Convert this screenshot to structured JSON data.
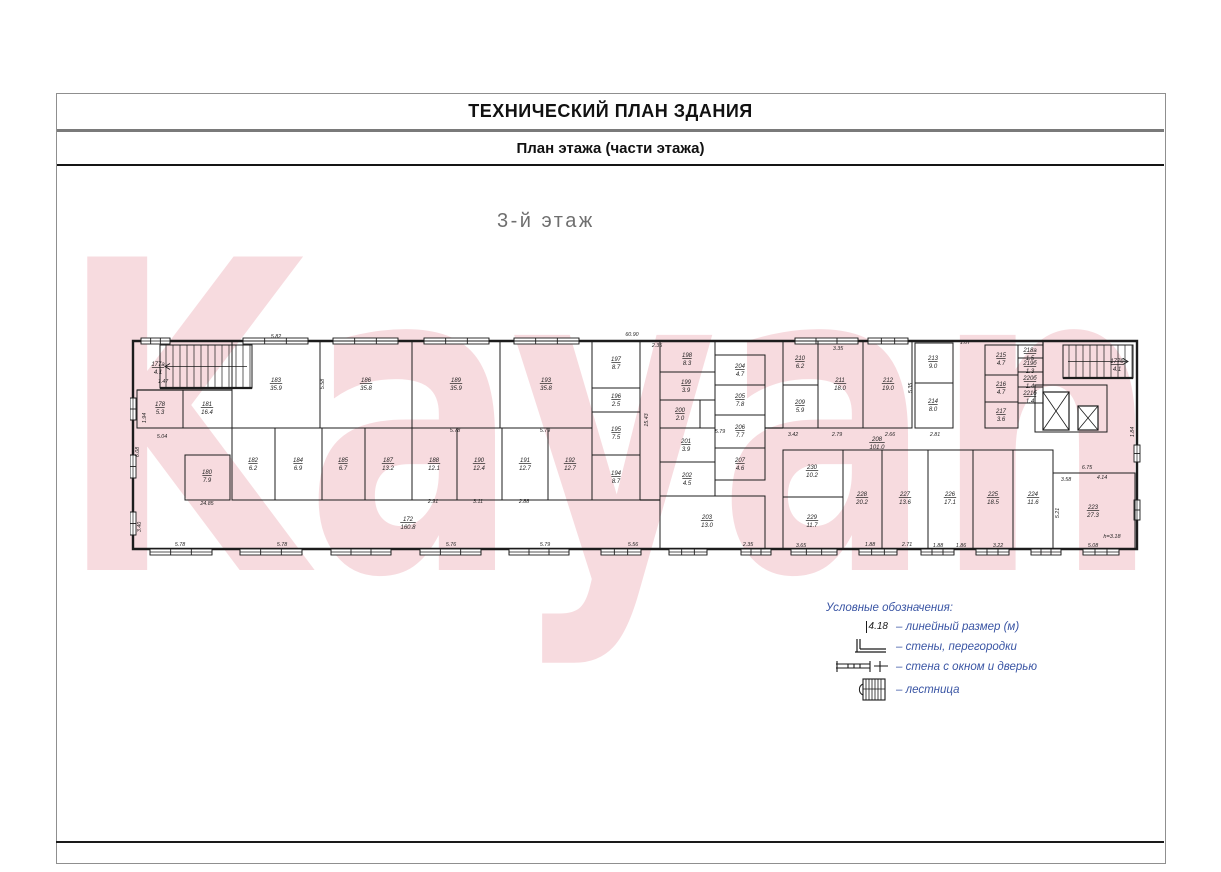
{
  "page": {
    "title": "ТЕХНИЧЕСКИЙ ПЛАН ЗДАНИЯ",
    "subtitle": "План этажа (части этажа)",
    "floor_label": "3-й этаж",
    "watermark": "Kayan"
  },
  "colors": {
    "watermark_pink": "#f6d3d8",
    "legend_blue": "#3a55a4",
    "wall_black": "#1c1c1c",
    "dim_text": "#1f1f1f",
    "floor_label_gray": "#6f6f6f"
  },
  "legend": {
    "heading": "Условные обозначения:",
    "items": [
      {
        "symbol": "linear-dimension",
        "sample": "4.18",
        "label": "– линейный размер (м)"
      },
      {
        "symbol": "walls-partitions",
        "sample": "",
        "label": "– стены, перегородки"
      },
      {
        "symbol": "wall-window-door",
        "sample": "",
        "label": "– стена с окном и дверью"
      },
      {
        "symbol": "stairs",
        "sample": "",
        "label": "– лестница"
      }
    ]
  },
  "plan": {
    "note": {
      "text": "h=3.18",
      "x": 1112,
      "y": 538
    },
    "rooms": [
      {
        "num": "177а",
        "area": "4.1",
        "label": [
          158,
          366
        ]
      },
      {
        "num": "178",
        "area": "5.3",
        "rect": [
          137,
          390,
          46,
          38
        ],
        "label": [
          160,
          406
        ]
      },
      {
        "num": "181",
        "area": "16.4",
        "rect": [
          183,
          390,
          49,
          38
        ],
        "label": [
          207,
          406
        ]
      },
      {
        "num": "183",
        "area": "35.9",
        "rect": [
          232,
          341,
          88,
          87
        ],
        "label": [
          276,
          382
        ]
      },
      {
        "num": "186",
        "area": "35.8",
        "rect": [
          320,
          341,
          92,
          87
        ],
        "label": [
          366,
          382
        ]
      },
      {
        "num": "189",
        "area": "35.9",
        "rect": [
          412,
          341,
          88,
          87
        ],
        "label": [
          456,
          382
        ]
      },
      {
        "num": "193",
        "area": "35.8",
        "rect": [
          500,
          341,
          92,
          87
        ],
        "label": [
          546,
          382
        ]
      },
      {
        "num": "180",
        "area": "7.9",
        "rect": [
          185,
          455,
          45,
          45
        ],
        "label": [
          207,
          474
        ]
      },
      {
        "num": "182",
        "area": "6.2",
        "rect": [
          232,
          428,
          43,
          72
        ],
        "label": [
          253,
          462
        ]
      },
      {
        "num": "184",
        "area": "6.9",
        "rect": [
          275,
          428,
          47,
          72
        ],
        "label": [
          298,
          462
        ]
      },
      {
        "num": "185",
        "area": "6.7",
        "rect": [
          322,
          428,
          43,
          72
        ],
        "label": [
          343,
          462
        ]
      },
      {
        "num": "187",
        "area": "13.2",
        "rect": [
          365,
          428,
          47,
          72
        ],
        "label": [
          388,
          462
        ]
      },
      {
        "num": "188",
        "area": "12.1",
        "rect": [
          412,
          428,
          45,
          72
        ],
        "label": [
          434,
          462
        ]
      },
      {
        "num": "190",
        "area": "12.4",
        "rect": [
          457,
          428,
          45,
          72
        ],
        "label": [
          479,
          462
        ]
      },
      {
        "num": "191",
        "area": "12.7",
        "rect": [
          502,
          428,
          46,
          72
        ],
        "label": [
          525,
          462
        ]
      },
      {
        "num": "192",
        "area": "12.7",
        "rect": [
          548,
          428,
          44,
          72
        ],
        "label": [
          570,
          462
        ]
      },
      {
        "num": "172",
        "area": "160.8",
        "label": [
          408,
          521
        ]
      },
      {
        "num": "197",
        "area": "8.7",
        "rect": [
          592,
          341,
          48,
          47
        ],
        "label": [
          616,
          361
        ]
      },
      {
        "num": "196",
        "area": "2.5",
        "rect": [
          592,
          388,
          48,
          24
        ],
        "label": [
          616,
          398
        ]
      },
      {
        "num": "195",
        "area": "7.5",
        "rect": [
          592,
          412,
          48,
          43
        ],
        "label": [
          616,
          431
        ]
      },
      {
        "num": "194",
        "area": "8.7",
        "rect": [
          592,
          455,
          48,
          45
        ],
        "label": [
          616,
          475
        ]
      },
      {
        "num": "198",
        "area": "8.3",
        "rect": [
          660,
          341,
          55,
          31
        ],
        "label": [
          687,
          357
        ]
      },
      {
        "num": "199",
        "area": "3.9",
        "rect": [
          660,
          372,
          55,
          28
        ],
        "label": [
          686,
          384
        ]
      },
      {
        "num": "200",
        "area": "2.0",
        "rect": [
          660,
          400,
          40,
          28
        ],
        "label": [
          680,
          412
        ]
      },
      {
        "num": "201",
        "area": "3.9",
        "rect": [
          660,
          428,
          55,
          34
        ],
        "label": [
          686,
          443
        ]
      },
      {
        "num": "202",
        "area": "4.5",
        "rect": [
          660,
          462,
          55,
          34
        ],
        "label": [
          687,
          477
        ]
      },
      {
        "num": "204",
        "area": "4.7",
        "rect": [
          715,
          355,
          50,
          30
        ],
        "label": [
          740,
          368
        ]
      },
      {
        "num": "205",
        "area": "7.8",
        "rect": [
          715,
          385,
          50,
          30
        ],
        "label": [
          740,
          398
        ]
      },
      {
        "num": "206",
        "area": "7.7",
        "rect": [
          715,
          415,
          50,
          33
        ],
        "label": [
          740,
          429
        ]
      },
      {
        "num": "207",
        "area": "4.6",
        "rect": [
          715,
          448,
          50,
          32
        ],
        "label": [
          740,
          462
        ]
      },
      {
        "num": "203",
        "area": "13.0",
        "rect": [
          660,
          496,
          105,
          53
        ],
        "label": [
          707,
          519
        ]
      },
      {
        "num": "210",
        "area": "6.2",
        "rect": [
          783,
          341,
          35,
          44
        ],
        "label": [
          800,
          360
        ]
      },
      {
        "num": "209",
        "area": "5.9",
        "rect": [
          783,
          385,
          35,
          43
        ],
        "label": [
          800,
          404
        ]
      },
      {
        "num": "211",
        "area": "18.0",
        "rect": [
          818,
          341,
          45,
          87
        ],
        "label": [
          840,
          382
        ]
      },
      {
        "num": "212",
        "area": "19.0",
        "rect": [
          863,
          341,
          49,
          87
        ],
        "label": [
          888,
          382
        ]
      },
      {
        "num": "213",
        "area": "9.0",
        "rect": [
          915,
          343,
          38,
          40
        ],
        "label": [
          933,
          360
        ]
      },
      {
        "num": "214",
        "area": "8.0",
        "rect": [
          915,
          383,
          38,
          45
        ],
        "label": [
          933,
          403
        ]
      },
      {
        "num": "215",
        "area": "4.7",
        "rect": [
          985,
          345,
          33,
          30
        ],
        "label": [
          1001,
          357
        ]
      },
      {
        "num": "216",
        "area": "4.7",
        "rect": [
          985,
          375,
          33,
          27
        ],
        "label": [
          1001,
          386
        ]
      },
      {
        "num": "217",
        "area": "3.6",
        "rect": [
          985,
          402,
          33,
          26
        ],
        "label": [
          1001,
          413
        ]
      },
      {
        "num": "218а",
        "area": "1.5",
        "rect": [
          1018,
          345,
          25,
          13
        ],
        "label": [
          1030,
          352
        ]
      },
      {
        "num": "219б",
        "area": "1.3",
        "rect": [
          1018,
          358,
          25,
          14
        ],
        "label": [
          1030,
          365
        ]
      },
      {
        "num": "220б",
        "area": "1.4",
        "rect": [
          1018,
          372,
          25,
          15
        ],
        "label": [
          1030,
          380
        ]
      },
      {
        "num": "221б",
        "area": "1.4",
        "rect": [
          1018,
          387,
          25,
          16
        ],
        "label": [
          1030,
          395
        ]
      },
      {
        "num": "208",
        "area": "101.0",
        "label": [
          877,
          441
        ]
      },
      {
        "num": "230",
        "area": "10.2",
        "rect": [
          783,
          450,
          60,
          47
        ],
        "label": [
          812,
          469
        ]
      },
      {
        "num": "229",
        "area": "11.7",
        "rect": [
          783,
          497,
          60,
          52
        ],
        "label": [
          812,
          519
        ]
      },
      {
        "num": "228",
        "area": "20.2",
        "rect": [
          843,
          450,
          39,
          99
        ],
        "label": [
          862,
          496
        ]
      },
      {
        "num": "227",
        "area": "13.6",
        "rect": [
          882,
          450,
          46,
          99
        ],
        "label": [
          905,
          496
        ]
      },
      {
        "num": "226",
        "area": "17.1",
        "rect": [
          928,
          450,
          45,
          99
        ],
        "label": [
          950,
          496
        ]
      },
      {
        "num": "225",
        "area": "18.5",
        "rect": [
          973,
          450,
          40,
          99
        ],
        "label": [
          993,
          496
        ]
      },
      {
        "num": "224",
        "area": "11.6",
        "rect": [
          1013,
          450,
          40,
          99
        ],
        "label": [
          1033,
          496
        ]
      },
      {
        "num": "223",
        "area": "27.3",
        "rect": [
          1053,
          473,
          82,
          76
        ],
        "label": [
          1093,
          509
        ]
      },
      {
        "num": "177б",
        "area": "4.1",
        "label": [
          1117,
          363
        ]
      }
    ],
    "dimensions": [
      {
        "t": "5.82",
        "x": 276,
        "y": 338
      },
      {
        "t": "60.90",
        "x": 632,
        "y": 336
      },
      {
        "t": "2.35",
        "x": 657,
        "y": 347
      },
      {
        "t": "3.35",
        "x": 838,
        "y": 350
      },
      {
        "t": "1.07",
        "x": 965,
        "y": 344
      },
      {
        "t": "5.78",
        "x": 180,
        "y": 546
      },
      {
        "t": "5.78",
        "x": 282,
        "y": 546
      },
      {
        "t": "5.76",
        "x": 451,
        "y": 546
      },
      {
        "t": "5.79",
        "x": 545,
        "y": 546
      },
      {
        "t": "5.56",
        "x": 633,
        "y": 546
      },
      {
        "t": "2.35",
        "x": 748,
        "y": 546
      },
      {
        "t": "3.65",
        "x": 801,
        "y": 547
      },
      {
        "t": "1.88",
        "x": 870,
        "y": 546
      },
      {
        "t": "2.71",
        "x": 907,
        "y": 546
      },
      {
        "t": "1.88",
        "x": 938,
        "y": 547
      },
      {
        "t": "1.86",
        "x": 961,
        "y": 547
      },
      {
        "t": "3.22",
        "x": 998,
        "y": 547
      },
      {
        "t": "5.08",
        "x": 1093,
        "y": 547
      },
      {
        "t": "6.08",
        "x": 139,
        "y": 452,
        "r": -90
      },
      {
        "t": "1.94",
        "x": 146,
        "y": 418,
        "r": -90
      },
      {
        "t": "3.40",
        "x": 141,
        "y": 527,
        "r": -90
      },
      {
        "t": "1.84",
        "x": 1134,
        "y": 432,
        "r": -90
      },
      {
        "t": "5.21",
        "x": 1059,
        "y": 513,
        "r": -90
      },
      {
        "t": "24.85",
        "x": 207,
        "y": 505
      },
      {
        "t": "2.91",
        "x": 433,
        "y": 503
      },
      {
        "t": "3.11",
        "x": 478,
        "y": 503
      },
      {
        "t": "2.88",
        "x": 524,
        "y": 503
      },
      {
        "t": "5.78",
        "x": 455,
        "y": 432
      },
      {
        "t": "5.79",
        "x": 545,
        "y": 432
      },
      {
        "t": "5.04",
        "x": 162,
        "y": 438
      },
      {
        "t": "5.79",
        "x": 720,
        "y": 433
      },
      {
        "t": "3.42",
        "x": 793,
        "y": 436
      },
      {
        "t": "2.79",
        "x": 837,
        "y": 436
      },
      {
        "t": "2.66",
        "x": 890,
        "y": 436
      },
      {
        "t": "2.81",
        "x": 935,
        "y": 436
      },
      {
        "t": "15.43",
        "x": 648,
        "y": 420,
        "r": -90
      },
      {
        "t": "6.75",
        "x": 1087,
        "y": 469
      },
      {
        "t": "4.14",
        "x": 1102,
        "y": 479
      },
      {
        "t": "3.58",
        "x": 1066,
        "y": 481
      },
      {
        "t": "1.47",
        "x": 163,
        "y": 383
      },
      {
        "t": "5.58",
        "x": 324,
        "y": 384,
        "r": -90
      },
      {
        "t": "5.35",
        "x": 912,
        "y": 388,
        "r": -90
      }
    ],
    "windows": [
      {
        "o": "h",
        "x1": 150,
        "x2": 212,
        "y": 552
      },
      {
        "o": "h",
        "x1": 240,
        "x2": 302,
        "y": 552
      },
      {
        "o": "h",
        "x1": 331,
        "x2": 391,
        "y": 552
      },
      {
        "o": "h",
        "x1": 420,
        "x2": 481,
        "y": 552
      },
      {
        "o": "h",
        "x1": 509,
        "x2": 569,
        "y": 552
      },
      {
        "o": "h",
        "x1": 601,
        "x2": 641,
        "y": 552
      },
      {
        "o": "h",
        "x1": 669,
        "x2": 707,
        "y": 552
      },
      {
        "o": "h",
        "x1": 741,
        "x2": 771,
        "y": 552
      },
      {
        "o": "h",
        "x1": 791,
        "x2": 837,
        "y": 552
      },
      {
        "o": "h",
        "x1": 859,
        "x2": 897,
        "y": 552
      },
      {
        "o": "h",
        "x1": 921,
        "x2": 954,
        "y": 552
      },
      {
        "o": "h",
        "x1": 976,
        "x2": 1009,
        "y": 552
      },
      {
        "o": "h",
        "x1": 1031,
        "x2": 1061,
        "y": 552
      },
      {
        "o": "h",
        "x1": 1083,
        "x2": 1119,
        "y": 552
      },
      {
        "o": "h",
        "x1": 141,
        "x2": 170,
        "y": 341
      },
      {
        "o": "h",
        "x1": 243,
        "x2": 308,
        "y": 341
      },
      {
        "o": "h",
        "x1": 333,
        "x2": 398,
        "y": 341
      },
      {
        "o": "h",
        "x1": 424,
        "x2": 489,
        "y": 341
      },
      {
        "o": "h",
        "x1": 514,
        "x2": 579,
        "y": 341
      },
      {
        "o": "h",
        "x1": 795,
        "x2": 858,
        "y": 341
      },
      {
        "o": "h",
        "x1": 868,
        "x2": 908,
        "y": 341
      },
      {
        "o": "v",
        "y1": 398,
        "y2": 420,
        "x": 133
      },
      {
        "o": "v",
        "y1": 455,
        "y2": 478,
        "x": 133
      },
      {
        "o": "v",
        "y1": 512,
        "y2": 535,
        "x": 133
      },
      {
        "o": "v",
        "y1": 445,
        "y2": 462,
        "x": 1137
      },
      {
        "o": "v",
        "y1": 500,
        "y2": 520,
        "x": 1137
      }
    ],
    "stairs": [
      {
        "x": 160,
        "y": 345,
        "w": 92,
        "h": 43,
        "dir": "left"
      },
      {
        "x": 1063,
        "y": 345,
        "w": 70,
        "h": 33,
        "dir": "right"
      }
    ],
    "elevators": [
      {
        "x": 1043,
        "y": 392,
        "w": 26,
        "h": 38
      },
      {
        "x": 1078,
        "y": 406,
        "w": 20,
        "h": 24
      }
    ],
    "machine_room": [
      1035,
      385,
      72,
      47
    ],
    "extra_walls": [
      [
        137,
        390,
        232,
        390
      ],
      [
        640,
        500,
        660,
        500
      ],
      [
        765,
        428,
        783,
        428
      ],
      [
        1043,
        341,
        1043,
        385
      ]
    ]
  }
}
